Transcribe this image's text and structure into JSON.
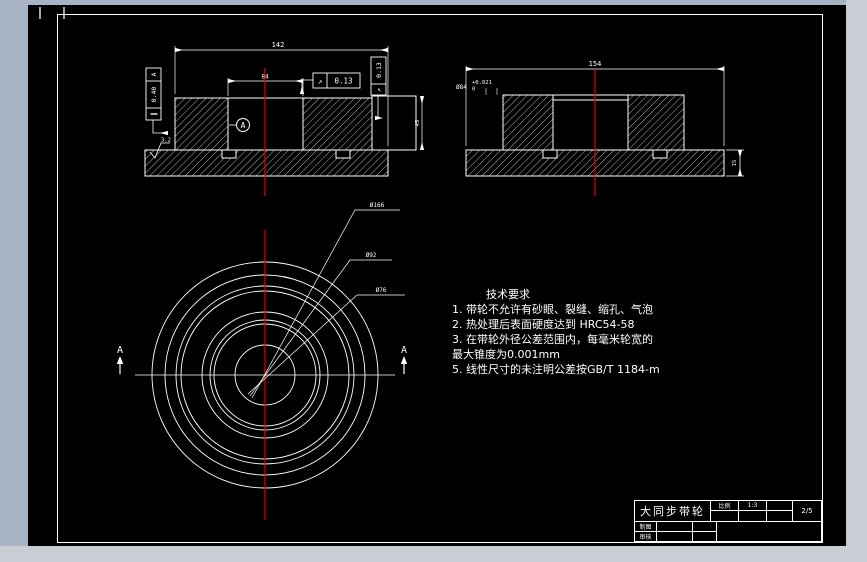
{
  "drawing": {
    "colors": {
      "centerline": "#e60000",
      "line": "#ffffff",
      "canvas": "#000000",
      "workspace": "#a8b4c6",
      "chrome": "#c9ced5"
    }
  },
  "views": {
    "left_section": {
      "width_dim": "142",
      "bore_dim": "84",
      "fcf_parallel": {
        "symbol": "∥",
        "value": "0.40",
        "datum": "A"
      },
      "fcf_runout_h": {
        "symbol": "↗",
        "value": "0.13"
      },
      "fcf_runout_v": {
        "symbol": "↗",
        "value": "0.13"
      },
      "datum_label": "A",
      "roughness": "3.2",
      "side_dim": "45"
    },
    "right_section": {
      "width_dim": "154",
      "bore_dia": "Ø84",
      "tol_upper": "+0.021",
      "tol_lower": "0",
      "thickness_dim": "15"
    },
    "front": {
      "section_label": "A",
      "callouts": [
        "Ø166",
        "Ø92",
        "Ø76"
      ]
    }
  },
  "tech_notes": {
    "heading": "技术要求",
    "lines": [
      "1. 带轮不允许有砂眼、裂缝、缩孔、气泡",
      "2. 热处理后表面硬度达到 HRC54-58",
      "3. 在带轮外径公差范围内，每毫米轮宽的",
      "最大锥度为0.001mm",
      "5. 线性尺寸的未注明公差按GB/T 1184-m"
    ]
  },
  "title_block": {
    "part_name": "大同步带轮",
    "scale_label": "比例",
    "scale_value": "1:3",
    "sheet": "2/5",
    "drawn_label": "制图",
    "checked_label": "审核"
  }
}
